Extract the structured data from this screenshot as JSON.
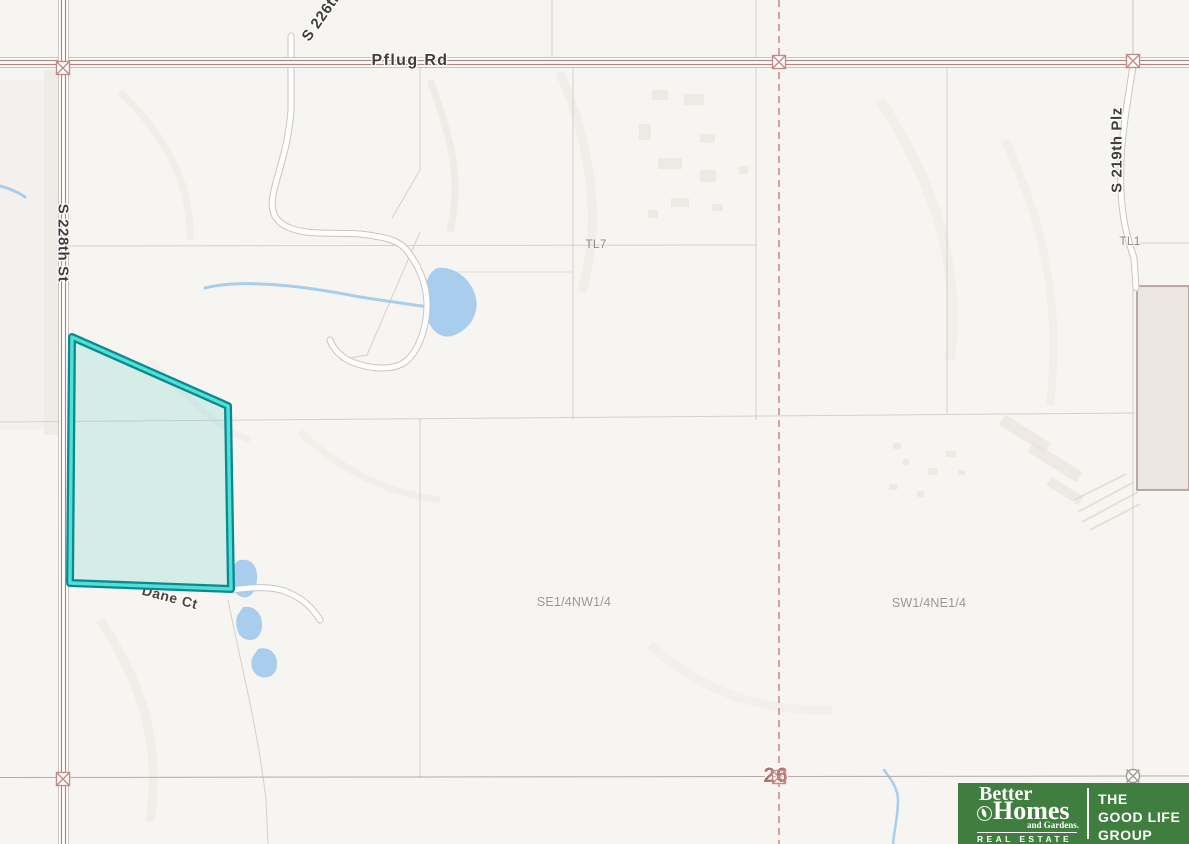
{
  "map": {
    "labels": {
      "pflug_rd": "Pflug Rd",
      "s_228th_st": "S 228th St",
      "s_226th": "S 226th",
      "s_219th_plz": "S 219th Plz",
      "tl7": "TL7",
      "tl1": "TL1",
      "quarter_se": "SE1/4NW1/4",
      "quarter_sw": "SW1/4NE1/4",
      "dane_ct": "Dane Ct",
      "section_number": "26"
    },
    "highlighted_parcel": {
      "outline_color": "#0e8791",
      "inner_line_color": "#4ce2d6",
      "fill_color": "#7fd8cc"
    },
    "style_colors": {
      "background": "#f7f5f2",
      "major_road_line": "#b5837d",
      "road_casing": "#c9c5c1",
      "section_dashed_line": "#c4827e",
      "section_line": "#b7a9a3",
      "parcel_line": "#d5d0cb",
      "water": "#a9cdec",
      "corner_marker": "#c28b87",
      "section_number_color": "#b5716d"
    }
  },
  "logo": {
    "brand_green": "#3f7e3e",
    "better": "Better",
    "homes": "Homes",
    "and_gardens": "and Gardens.",
    "real_estate": "REAL ESTATE",
    "tagline_line1": "THE",
    "tagline_line2": "GOOD LIFE",
    "tagline_line3": "GROUP"
  }
}
